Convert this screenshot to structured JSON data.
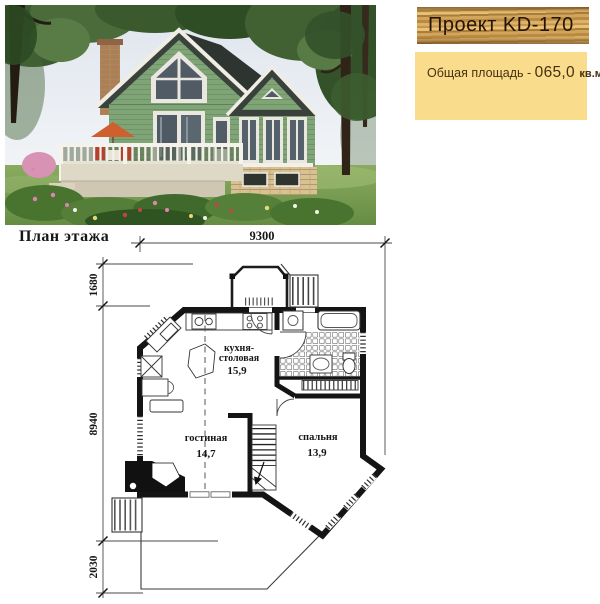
{
  "header": {
    "project_title": "Проект KD-170",
    "area_label": "Общая площадь - ",
    "area_value": "065,0",
    "area_unit": "кв.м."
  },
  "plan": {
    "title": "План этажа",
    "dimensions": {
      "top": "9300",
      "left_upper": "1680",
      "left_middle": "8940",
      "left_bottom": "2030"
    },
    "rooms": [
      {
        "name": "кухня-столовая",
        "line1": "кухня-",
        "line2": "столовая",
        "area": "15,9"
      },
      {
        "name": "гостиная",
        "line1": "гостиная",
        "line2": "",
        "area": "14,7"
      },
      {
        "name": "спальня",
        "line1": "спальня",
        "line2": "",
        "area": "13,9"
      }
    ]
  },
  "colors": {
    "banner_wood": "#c99a4f",
    "banner_text": "#241405",
    "area_box_bg": "#f9dc8c",
    "area_box_text": "#46300f",
    "plan_ink": "#141414",
    "house_siding": "#7fa577",
    "house_roof": "#39403b",
    "lawn_green": "#79a254"
  }
}
